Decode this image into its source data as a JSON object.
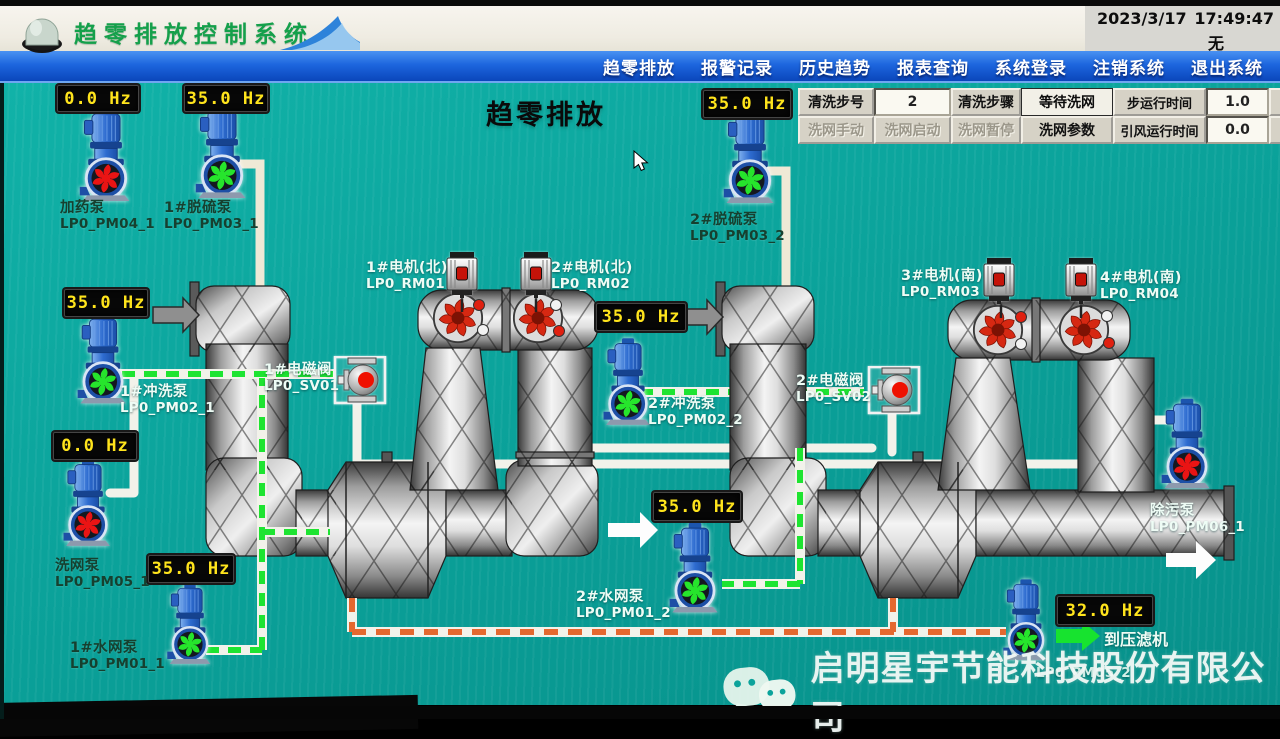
{
  "window": {
    "date": "2023/3/17",
    "time": "17:49:47",
    "alarm_status": "无"
  },
  "header": {
    "title": "趋零排放控制系统"
  },
  "menu": {
    "items": [
      "趋零排放",
      "报警记录",
      "历史趋势",
      "报表查询",
      "系统登录",
      "注销系统",
      "退出系统"
    ]
  },
  "screen": {
    "title": "趋零排放"
  },
  "control_panel": {
    "step_no_label": "清洗步号",
    "step_no_value": "2",
    "step_name_label": "清洗步骤",
    "step_name_value": "等待洗网",
    "step_time_label": "步运行时间",
    "step_time_value": "1.0",
    "step_time_unit": "分",
    "btn_manual": "洗网手动",
    "btn_start": "洗网启动",
    "btn_pause": "洗网暂停",
    "btn_params": "洗网参数",
    "fan_time_label": "引风运行时间",
    "fan_time_value": "0.0",
    "fan_time_unit": "分"
  },
  "pumps": [
    {
      "name": "加药泵",
      "tag": "LP0_PM04_1",
      "freq": "0.0 Hz",
      "state": "stopped"
    },
    {
      "name": "1#脱硫泵",
      "tag": "LP0_PM03_1",
      "freq": "35.0 Hz",
      "state": "running"
    },
    {
      "name": "1#冲洗泵",
      "tag": "LP0_PM02_1",
      "freq": "35.0 Hz",
      "state": "running"
    },
    {
      "name": "洗网泵",
      "tag": "LP0_PM05_1",
      "freq": "0.0 Hz",
      "state": "stopped"
    },
    {
      "name": "1#水网泵",
      "tag": "LP0_PM01_1",
      "freq": "35.0 Hz",
      "state": "running"
    },
    {
      "name": "2#脱硫泵",
      "tag": "LP0_PM03_2",
      "freq": "35.0 Hz",
      "state": "running"
    },
    {
      "name": "2#冲洗泵",
      "tag": "LP0_PM02_2",
      "freq": "35.0 Hz",
      "state": "running"
    },
    {
      "name": "2#水网泵",
      "tag": "LP0_PM01_2",
      "freq": "35.0 Hz",
      "state": "running"
    },
    {
      "name": "除污泵",
      "tag": "LP0_PM06_1",
      "state": "stopped"
    },
    {
      "name": "",
      "tag": "LP0_PM05_2",
      "freq": "32.0 Hz",
      "state": "running"
    }
  ],
  "motors": [
    {
      "name": "1#电机(北)",
      "tag": "LP0_RM01"
    },
    {
      "name": "2#电机(北)",
      "tag": "LP0_RM02"
    },
    {
      "name": "3#电机(南)",
      "tag": "LP0_RM03"
    },
    {
      "name": "4#电机(南)",
      "tag": "LP0_RM04"
    }
  ],
  "valves": [
    {
      "name": "1#电磁阀",
      "tag": "LP0_SV01"
    },
    {
      "name": "2#电磁阀",
      "tag": "LP0_SV02"
    }
  ],
  "annotations": {
    "to_filter_press": "到压滤机"
  },
  "watermark": {
    "icon": "wechat-icon",
    "text": "启明星宇节能科技股份有限公司"
  },
  "colors": {
    "running": "#26e52c",
    "stopped": "#ea1414",
    "freq_text": "#ffe41c",
    "canvas_teal": "#0ba39b",
    "menu_blue": "#1d66de",
    "title_green": "#14a04b"
  }
}
